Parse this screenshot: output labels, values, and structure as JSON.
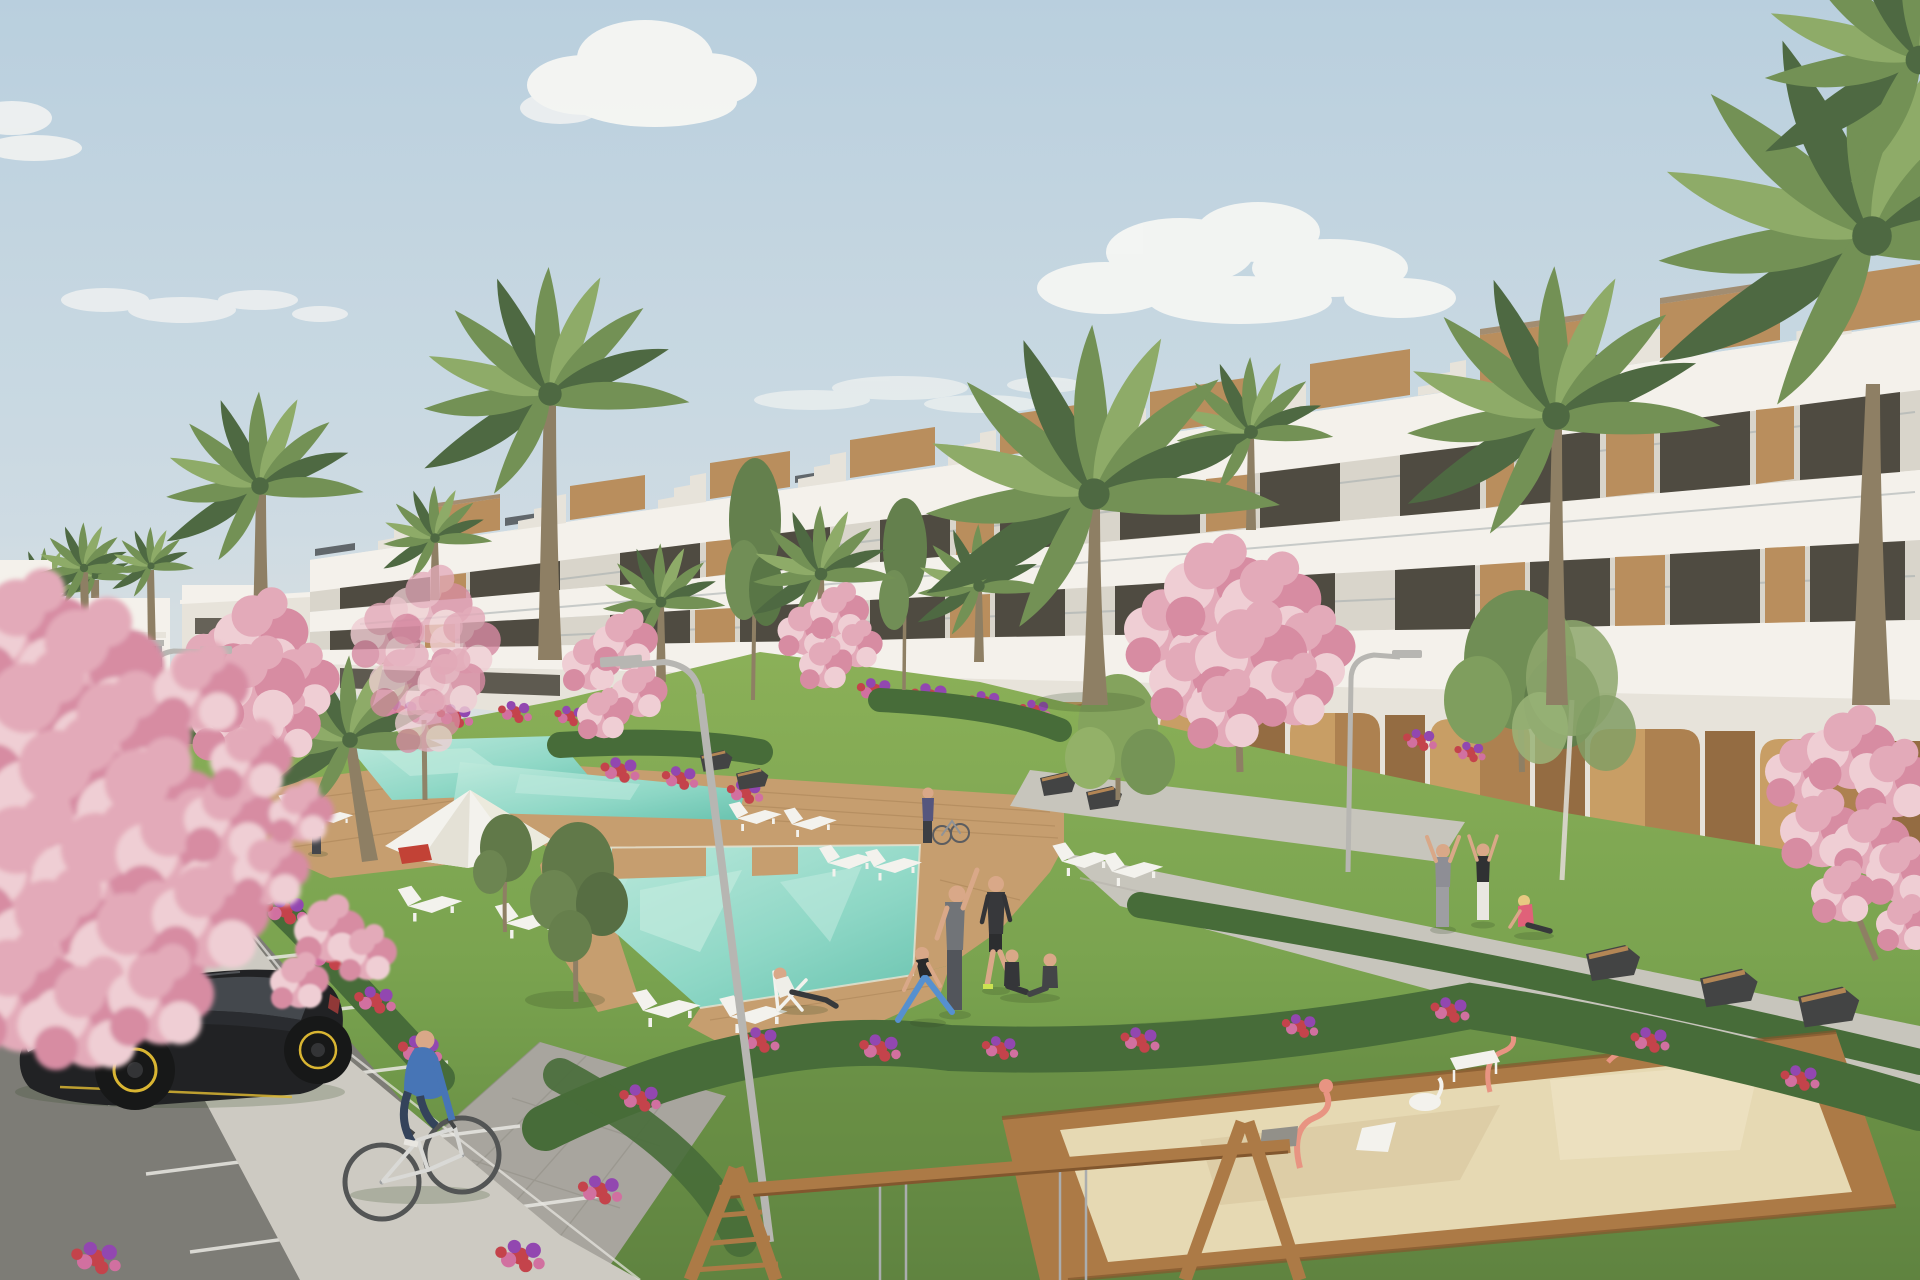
{
  "meta": {
    "title": "New-build residential complex — exterior render",
    "description": "Photorealistic 3D visualization of a modern white terraced apartment building with wood accents, rooftop terraces and stairs, communal gardens with palm and cherry-blossom trees, turquoise swimming pools with wooden decks and white sun loungers, a parasol, people jogging and exercising on the lawn, a man relaxing on a deck chair, residents stretching on a walkway with benches, a parking lot with a black hatchback and a distant sedan, a cyclist in a blue sweater, curved street lamps, and a children's playground with a wooden swing frame and a sandbox with pink toys."
  },
  "colors": {
    "sky_top": "#b7cedf",
    "sky_mid": "#cddbe4",
    "sky_horizon": "#ece8df",
    "cloud": "#f8f8f6",
    "bldg_white": "#f5f2ec",
    "bldg_shade": "#e7e3db",
    "bldg_strip": "#d9d4cb",
    "window_dark": "#474339",
    "glass_rail": "#9fa8ab",
    "wood": "#b78a57",
    "wood_dark": "#90663a",
    "arch_tan": "#c79a5f",
    "arch_shadow": "#96underscore",
    "solar": "#5a6066",
    "grass_light": "#86ad52",
    "grass": "#74a048",
    "grass_dark": "#597f38",
    "hedge": "#3f6631",
    "flower_red": "#c23a44",
    "flower_pink": "#d06a9e",
    "flower_purple": "#8e3fae",
    "blossom": "#e3a7b8",
    "blossom_light": "#f0cdd4",
    "blossom_deep": "#d687a0",
    "palm": "#6d8d4f",
    "palm_dark": "#46633a",
    "palm_light": "#8aa863",
    "trunk": "#8a7a5e",
    "pool": "#8fd9c8",
    "pool_light": "#bdeadd",
    "pool_deep": "#63c2ae",
    "deck": "#c49a6a",
    "deck_dark": "#a57d4e",
    "path": "#c6c3bb",
    "paver": "#a5a29b",
    "sidewalk": "#ccc9c1",
    "asphalt": "#787671",
    "line_white": "#e9e8e4",
    "furniture_white": "#f4f3ef",
    "bench_dark": "#3a3b3d",
    "bench_wood": "#b0814e",
    "play_wood": "#a9743f",
    "play_wood_dark": "#7d5025",
    "sand": "#e6d8b2",
    "toy_pink": "#e8907e",
    "lamp_metal": "#b5b4b0",
    "car_black": "#17181b",
    "car_glass": "#3c4046",
    "car_accent": "#d8b32a",
    "car_distant": "#2b3137",
    "skin": "#d9a584",
    "shadow": "#27421c",
    "teal_top": "#3aa6a0",
    "pink_top": "#e4a0b0",
    "red_shirt": "#c8352e",
    "blue_sweater": "#3f6fb5",
    "jeans": "#2b3a55",
    "sport_black": "#2e2f33",
    "legging_blue": "#4f8ccf",
    "hoodie_gray": "#8a8a92",
    "pink_sit": "#e05a74",
    "lime_shoe": "#cbe34a",
    "gray_outfit": "#6b6e73"
  },
  "scene": {
    "sky": {
      "clouds": 5
    },
    "building": {
      "floors": 3,
      "style": "white terraced with wood panels",
      "features": [
        "rooftop terraces",
        "roof stair bulkheads",
        "wooden roof boxes",
        "glass balcony railings",
        "ground-floor arched arcade",
        "solar panels"
      ]
    },
    "vegetation": [
      "palm trees",
      "cherry blossom trees",
      "olive trees",
      "hedges",
      "flower beds"
    ],
    "pools": [
      "upper lap pool",
      "mid lap pool",
      "main zigzag pool with wooden deck insets"
    ],
    "amenities": [
      "white parasol",
      "sun loungers",
      "deck chair",
      "angular benches",
      "street lamps"
    ],
    "playground": [
      "wooden swing frame",
      "sandbox with pink and white toys"
    ],
    "vehicles": [
      "black hatchback with yellow rims",
      "distant dark sedan",
      "white bicycle"
    ],
    "people": [
      {
        "name": "jogger-teal",
        "desc": "woman jogging, teal top"
      },
      {
        "name": "jogger-pink",
        "desc": "woman jogging, pink top"
      },
      {
        "name": "man-with-ball",
        "desc": "man in gray with soccer ball"
      },
      {
        "name": "man-red",
        "desc": "man in red shirt bending"
      },
      {
        "name": "stretching-man",
        "desc": "man side-stretching on lawn"
      },
      {
        "name": "walking-man",
        "desc": "man in black sportswear, lime shoes"
      },
      {
        "name": "yoga-woman",
        "desc": "woman lunging, blue leggings"
      },
      {
        "name": "seated-pair",
        "desc": "two people sitting on grass"
      },
      {
        "name": "reclining-man",
        "desc": "man on white deck chair by pool"
      },
      {
        "name": "arms-up-man",
        "desc": "man stretching arms up on walkway"
      },
      {
        "name": "arms-up-woman",
        "desc": "woman stretching, black top white pants"
      },
      {
        "name": "seated-pink-woman",
        "desc": "woman in pink sitting on path"
      },
      {
        "name": "cyclist",
        "desc": "man in blue sweater riding bicycle"
      },
      {
        "name": "person-with-bike",
        "desc": "small figure wheeling bike near building"
      }
    ]
  }
}
